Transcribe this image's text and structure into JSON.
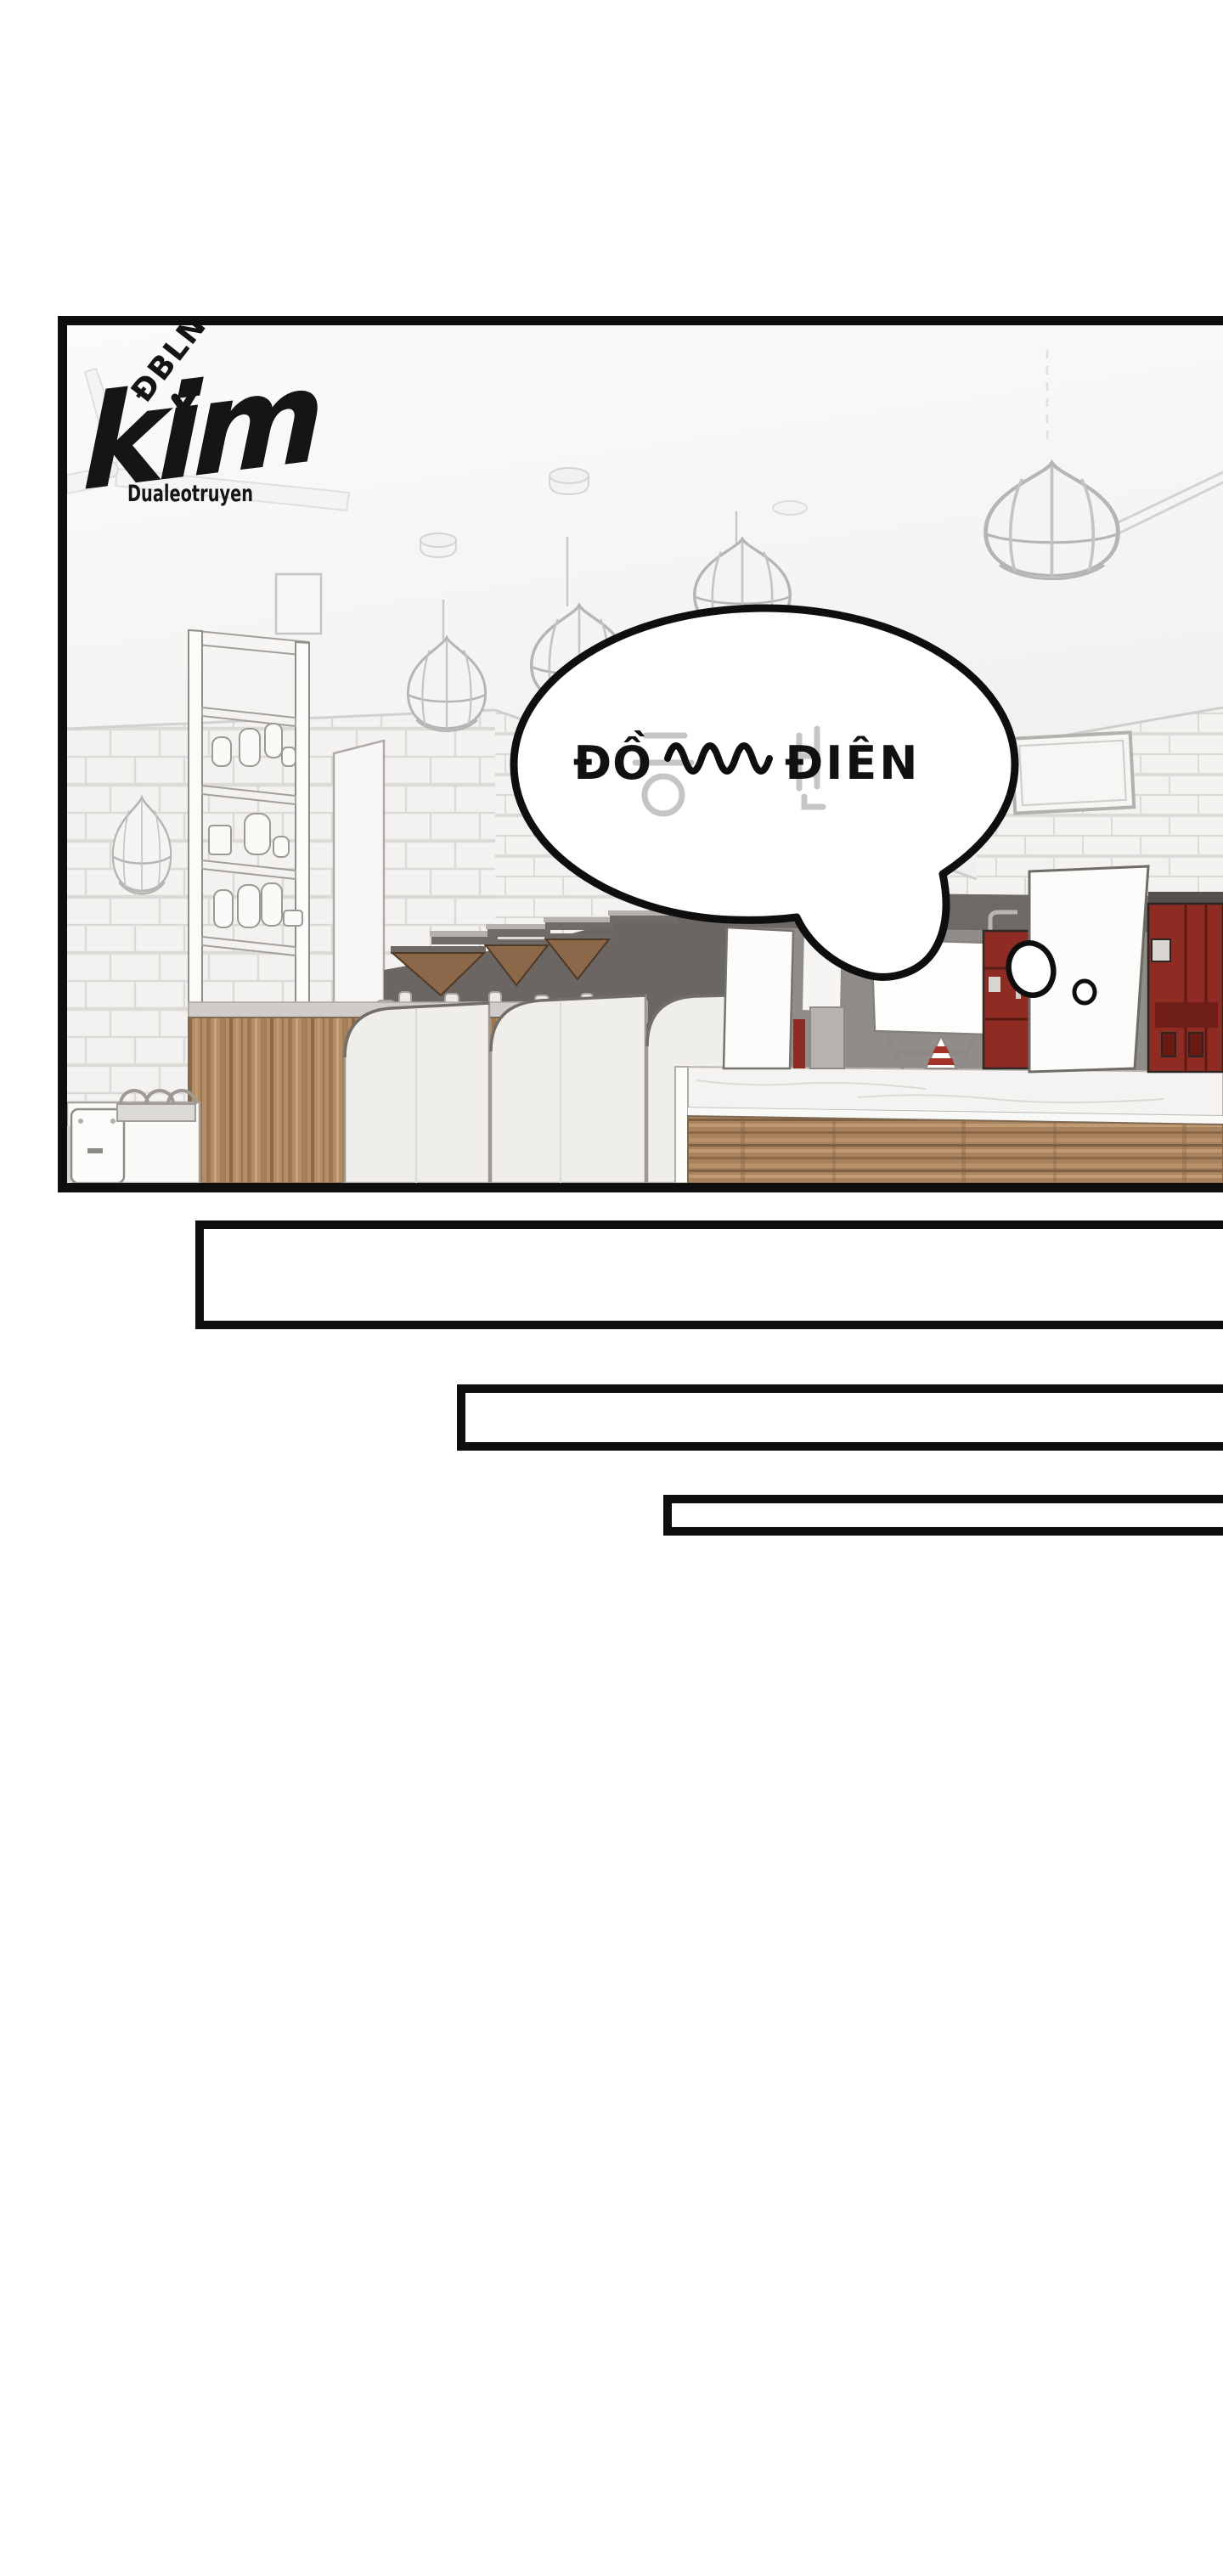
{
  "page": {
    "type": "webtoon comic page",
    "background": "#ffffff"
  },
  "translator_watermark": {
    "tag": "ĐBLN",
    "name": "kim",
    "site": "Dualeotruyen",
    "ink": "#151515"
  },
  "panel": {
    "border_color": "#0b0b0b",
    "scene": "empty cafe counter interior, pencil-sketch style, pendant lamps, tiled walls, pastry cases, coffee grinders, red espresso machines",
    "speech_bubble": {
      "text": "ĐỒ ∿∿∿∿ ĐIÊN",
      "text_prefix": "ĐỒ",
      "squiggle": "∿∿∿∿",
      "text_suffix": "ĐIÊN",
      "residual_korean_text": "등 빈",
      "fill": "#ffffff",
      "outline": "#0e0e0e",
      "text_color": "#111111",
      "thought_dots": 2
    }
  },
  "empty_boxes": {
    "count": 3
  },
  "colors": {
    "ink": "#0e0e0e",
    "machine_red": "#8e2b22",
    "machine_red_dark": "#6f1f18",
    "wood": "#b28d66",
    "wood_dark": "#8a6848",
    "dark_band": "#6b6662",
    "mid_grey": "#908c88",
    "tile": "#f3f2f0",
    "grout": "#dcdbd8",
    "line_grey": "#9c9894",
    "faint_grey": "#c9c7c5",
    "lamp_grey": "#b7b5b3"
  }
}
